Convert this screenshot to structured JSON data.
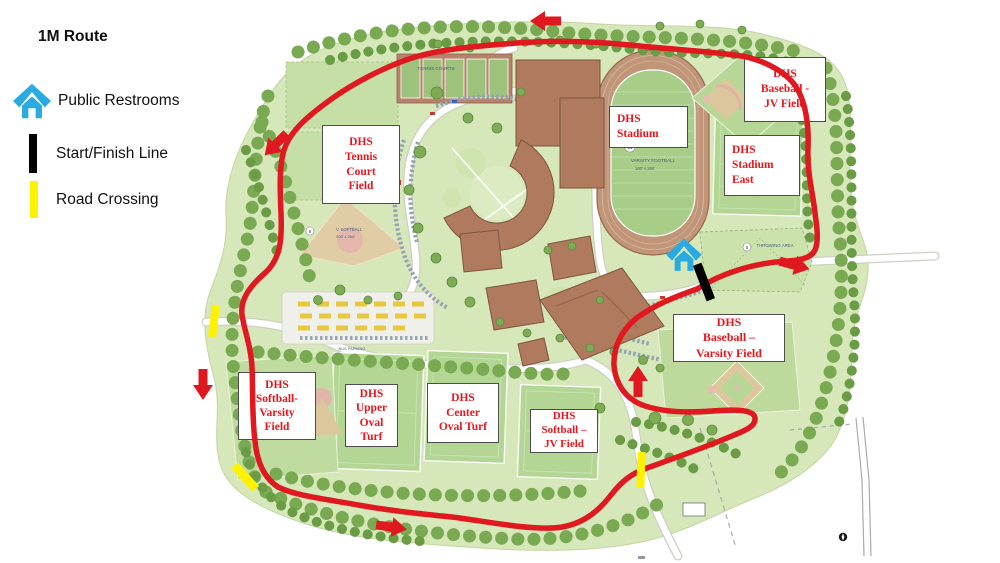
{
  "legend": {
    "title": "1M Route",
    "items": [
      {
        "label": "Public Restrooms",
        "icon": "restroom-house-icon"
      },
      {
        "label": "Start/Finish Line",
        "icon": "start-finish-bar-icon"
      },
      {
        "label": "Road Crossing",
        "icon": "road-crossing-bar-icon"
      }
    ]
  },
  "map_labels": [
    {
      "id": "tennis-court-field",
      "lines": [
        "DHS",
        "Tennis",
        "Court",
        "Field"
      ]
    },
    {
      "id": "stadium",
      "lines": [
        "DHS",
        "Stadium"
      ]
    },
    {
      "id": "baseball-jv-field",
      "lines": [
        "DHS",
        "Baseball -",
        "JV Field"
      ]
    },
    {
      "id": "stadium-east",
      "lines": [
        "DHS",
        "Stadium",
        "East"
      ]
    },
    {
      "id": "baseball-varsity-field",
      "lines": [
        "DHS",
        "Baseball –",
        "Varsity Field"
      ]
    },
    {
      "id": "softball-varsity-field",
      "lines": [
        "DHS",
        "Softball-",
        "Varsity",
        "Field"
      ]
    },
    {
      "id": "upper-oval-turf",
      "lines": [
        "DHS",
        "Upper",
        "Oval",
        "Turf"
      ]
    },
    {
      "id": "center-oval-turf",
      "lines": [
        "DHS",
        "Center",
        "Oval Turf"
      ]
    },
    {
      "id": "softball-jv-field",
      "lines": [
        "DHS",
        "Softball –",
        "JV Field"
      ]
    }
  ],
  "map_texts": {
    "tennis_courts": "TENNIS COURTS",
    "varsity_football": "VARSITY FOOTBALL",
    "varsity_football_dims": "160' x 360'",
    "field_11": "11",
    "stadium_east_num": "3",
    "stadium_east_fall": "(FALL)",
    "stadium_east_dims": "160' x 360'",
    "throwing_area": "THROWING AREA",
    "throwing_num": "5",
    "v_softball": "V. SOFTBALL",
    "v_softball_dims": "200' x 200'",
    "softball_num": "6",
    "bus_parking": "BUS PARKING"
  },
  "colors": {
    "route_red": "#e0181f",
    "label_red": "#e8151d",
    "restroom_blue": "#29abe2",
    "crossing_yellow": "#fff200",
    "start_finish_black": "#000000",
    "land_green": "#d6e7ba",
    "tree_green": "#79aa52",
    "building_brown": "#b07a5e",
    "track_brown": "#c09578"
  }
}
